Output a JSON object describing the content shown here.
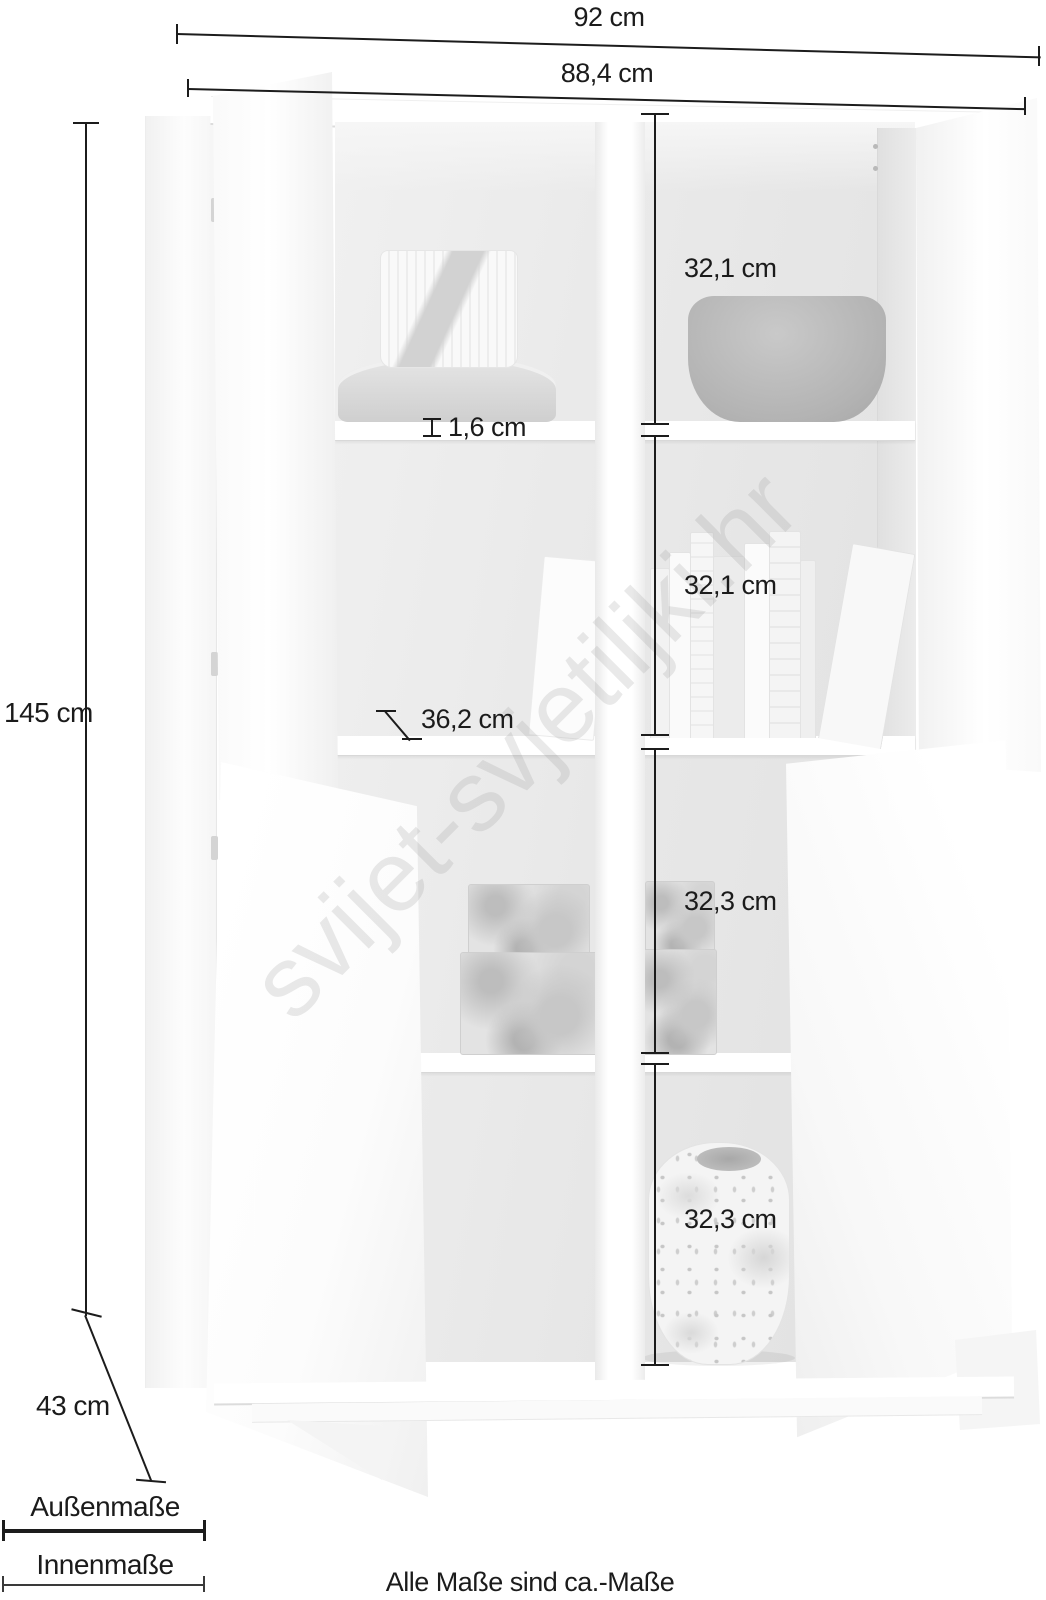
{
  "watermark": {
    "text": "svijet-svjetiljki.hr"
  },
  "measurements": {
    "outer_width": "92 cm",
    "inner_width": "88,4 cm",
    "height": "145 cm",
    "depth": "43 cm",
    "shelf_thickness": "1,6 cm",
    "inner_depth": "36,2 cm",
    "compartment_heights": [
      "32,1 cm",
      "32,1 cm",
      "32,3 cm",
      "32,3 cm"
    ]
  },
  "legend": {
    "outer_label": "Außenmaße",
    "inner_label": "Innenmaße"
  },
  "note": {
    "text": "Alle Maße sind ca.-Maße"
  },
  "colors": {
    "dimension_line": "#1c1c1c",
    "interior_gray": "#e7e7e7",
    "watermark_gray": "#9a9a9a",
    "background": "#ffffff"
  }
}
